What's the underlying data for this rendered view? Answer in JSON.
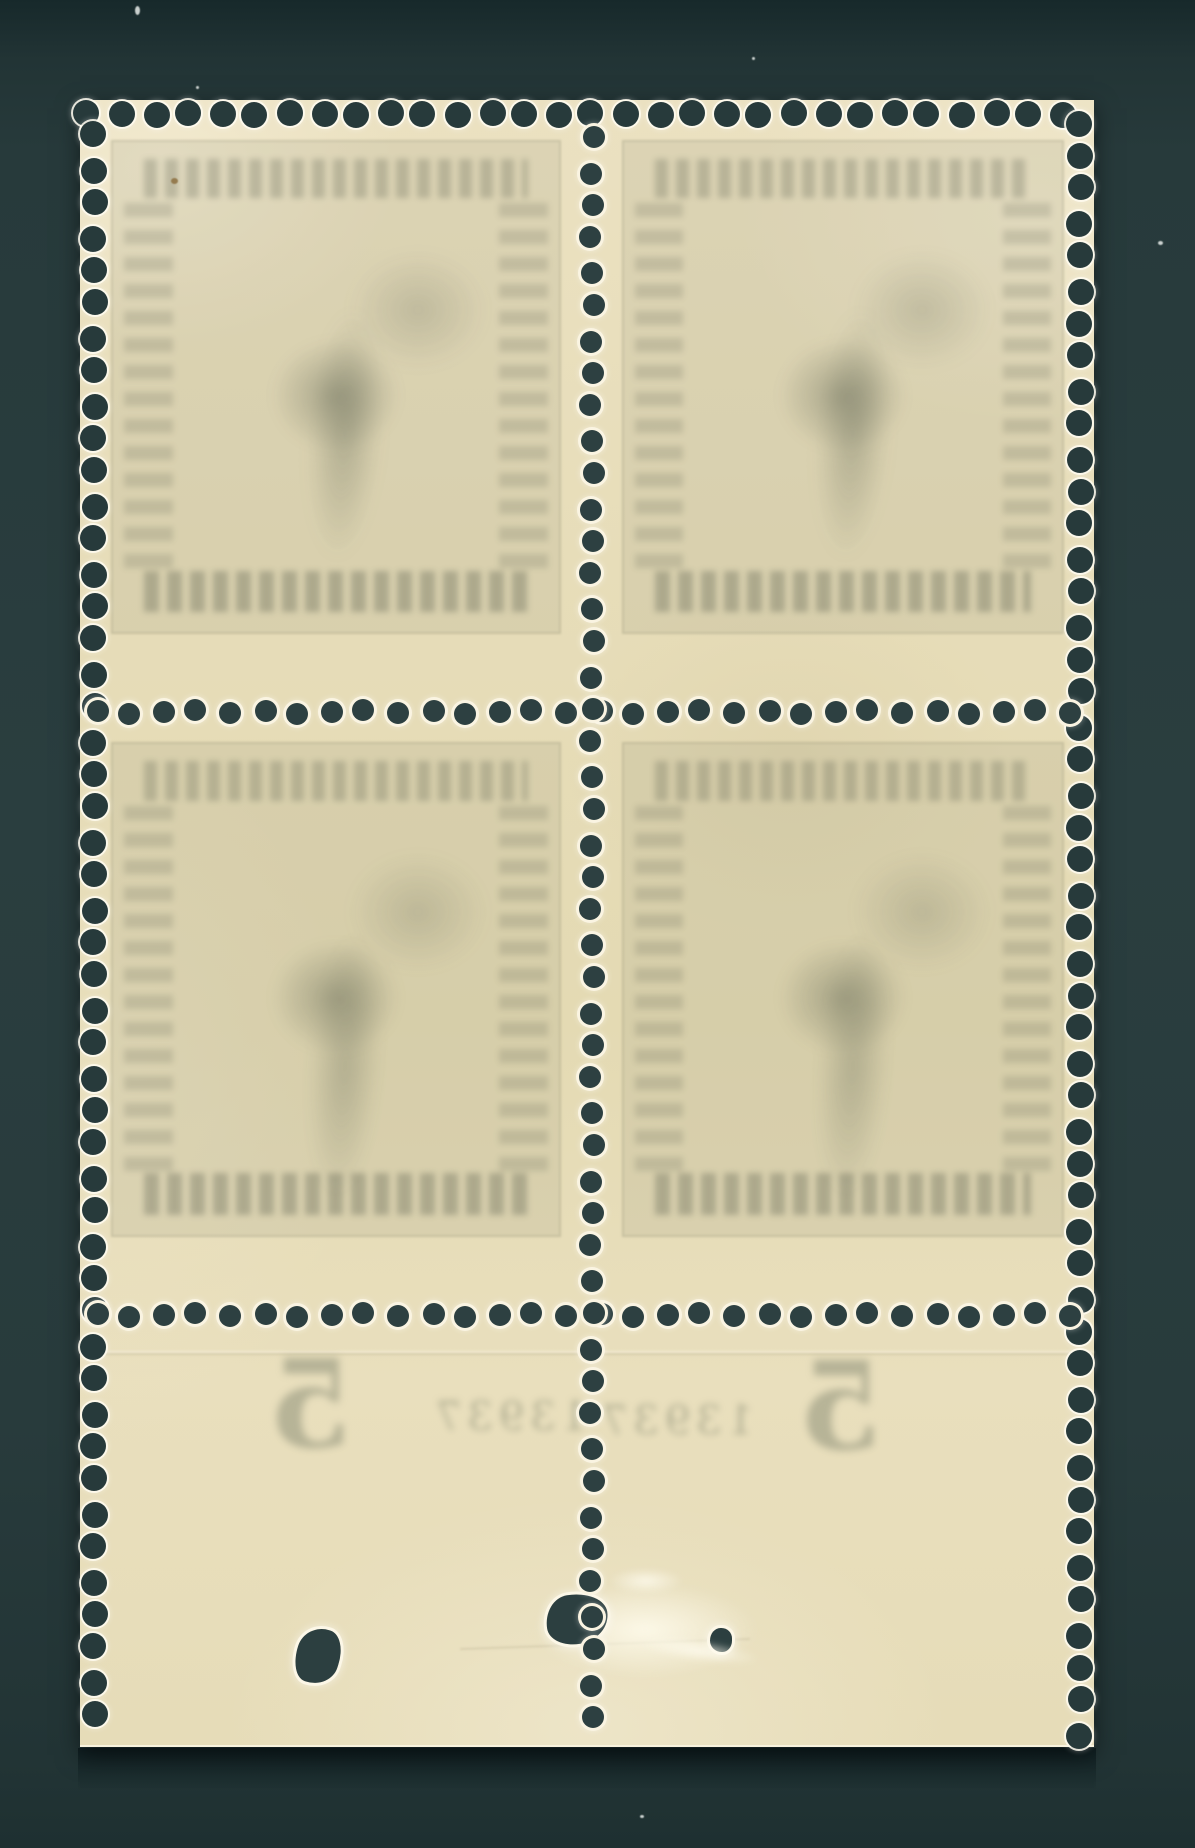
{
  "scene": {
    "subject": "Reverse (gum side) of a mint block of four stamps with attached bottom sheet margin, scanned on a dark background",
    "background_color": "#273a3b",
    "paper_color": "#e7ddb9",
    "perforation_hole_color": "#2d4041",
    "showthrough_ink_color": "#6f7560"
  },
  "sheet": {
    "stamps": [
      {
        "id": "top-left",
        "showthrough": "mirrored frame, lettering and central emblem"
      },
      {
        "id": "top-right",
        "showthrough": "mirrored frame, lettering and central emblem"
      },
      {
        "id": "bottom-left",
        "showthrough": "mirrored frame, lettering and central emblem"
      },
      {
        "id": "bottom-right",
        "showthrough": "mirrored frame, lettering and central emblem"
      }
    ],
    "margin": {
      "digit_left": "5",
      "digit_right": "5",
      "mark_left": "13937",
      "mark_right": "13937"
    },
    "flaws": [
      {
        "id": "hole-left",
        "label": "small tear hole in margin"
      },
      {
        "id": "tear-center",
        "label": "tear at centre perforation column"
      },
      {
        "id": "pinhole-right",
        "label": "pinhole with thinned gum patch"
      }
    ]
  }
}
